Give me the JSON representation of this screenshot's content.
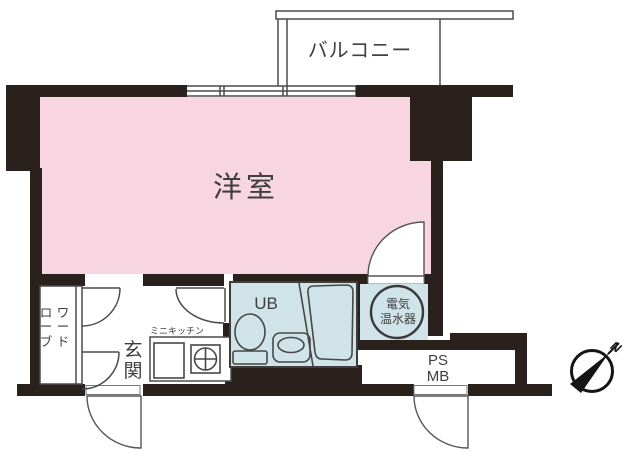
{
  "floorplan": {
    "labels": {
      "balcony": "バルコニー",
      "room": "洋室",
      "unit_bath": "UB",
      "water_heater_lines": [
        "電気",
        "温水器"
      ],
      "pipe_space": "PS",
      "meter_box": "MB",
      "entrance": "玄関",
      "wardrobe": "ワードローブ",
      "mini_kitchen": "ミニキッチン",
      "compass_north": "N"
    },
    "colors": {
      "room_fill": "#f7d5e1",
      "wet_area_fill": "#cfe3e9",
      "wall": "#2b211c",
      "line": "#4a4a4a",
      "text": "#3f3f3f"
    }
  }
}
